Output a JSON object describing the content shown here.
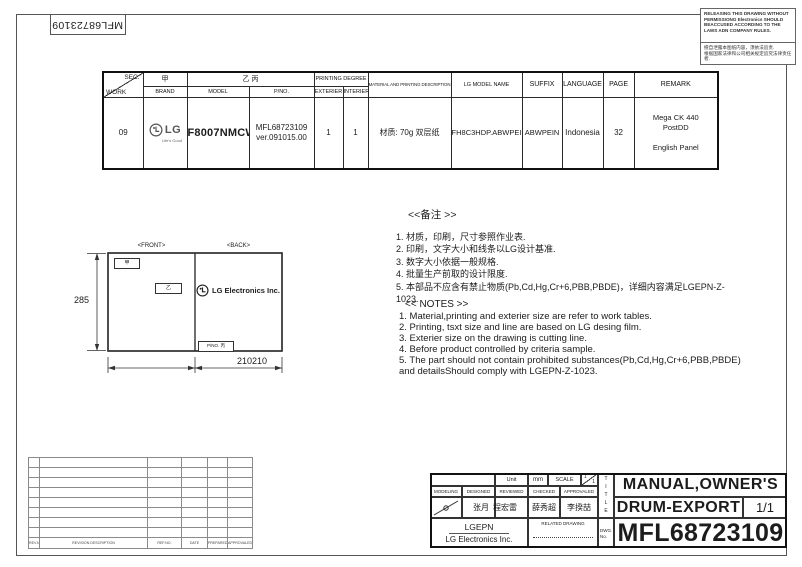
{
  "sheet": {
    "top_left_number": "MFL68723109",
    "disclaimer_en": "RELEASING THIS DRAWING WITHOUT PERMISSIONG Electronics SHOULD BEACCUSED ACCORDING TO THE LAWS ADN COMPANY RULES.",
    "disclaimer_cn_line1": "擅自泄露本图纸内容，须依法追责.",
    "disclaimer_cn_line2": "根据国家法律和公司相关规定追究法律责任者."
  },
  "spec_table": {
    "headers": {
      "sec": "SEC.",
      "work": "WORK",
      "jia": "甲",
      "brand": "BRAND",
      "yi_bing": "乙 丙",
      "model": "MODEL",
      "pno": "P/NO.",
      "printing_degree": "PRINTING DEGREE",
      "exterier": "EXTERIER",
      "interier": "INTERIER",
      "material": "MATERIAL AND PRINTING DESCRIPTION",
      "lg_model_name": "LG MODEL NAME",
      "suffix": "SUFFIX",
      "language": "LANGUAGE",
      "page": "PAGE",
      "remark": "REMARK"
    },
    "row": {
      "work_sec": "09",
      "brand_logo_text": "LG",
      "brand_tagline": "Life's Good",
      "model": "F8007NMCW",
      "pno_line1": "MFL68723109",
      "pno_line2": "ver.091015.00",
      "exterier": "1",
      "interier": "1",
      "material": "材质: 70g 双层纸",
      "lg_model_name": "FH8C3HDP.ABWPEIN",
      "suffix": "ABWPEIN",
      "language": "Indonesia",
      "page": "32",
      "remark": "Mega CK 440\nPostDD\n\nEnglish Panel"
    }
  },
  "drawing": {
    "front_label": "<FRONT>",
    "back_label": "<BACK>",
    "jia_box": "甲",
    "yi_box": "乙",
    "back_logo_text": "LG Electronics Inc.",
    "pno_box": "P/NO. 丙",
    "height_dim": "285",
    "width_dim": "210210"
  },
  "notes_cn": {
    "title": "<<备注 >>",
    "items": [
      "1.  材质，印刷，尺寸参照作业表.",
      "2.  印刷，文字大小和线条以LG设计基准.",
      "3.  数字大小依据一般规格.",
      "4.  批量生产前取的设计限度.",
      "5.  本部品不应含有禁止物质(Pb,Cd,Hg,Cr+6,PBB,PBDE)，详细内容满足LGEPN-Z-1023."
    ]
  },
  "notes_en": {
    "title": "<< NOTES >>",
    "items": [
      "1. Material,printing and exterier size are refer to work tables.",
      "2. Printing, tsxt  size and line are based on LG desing film.",
      "3. Exterier size on the drawing is cutting line.",
      "4. Before product controlled by criteria sample.",
      "5. The part should not contain prohibited substances(Pb,Cd,Hg,Cr+6,PBB,PBDE)\n    and detailsShould comply with LGEPN-Z-1023."
    ]
  },
  "revision_table": {
    "headers": [
      "REV.NO.",
      "REVISION DESCRIPTION",
      "REF.NO.",
      "DATE",
      "PREPARED",
      "APPROVALED"
    ]
  },
  "title_block": {
    "unit_label": "Unit",
    "unit_value": "mm",
    "scale_label": "SCALE",
    "scale_num": "1",
    "scale_den": "1",
    "modeling": "MODELING",
    "designed": "DESIGNED",
    "reviewed": "REVIEWED",
    "checked": "CHECKED",
    "approvaled": "APPROVALED",
    "sign_designed": "张月",
    "sign_reviewed": "程宏雷",
    "sign_checked": "薛秀超",
    "sign_approvaled": "李揆喆",
    "company_short": "LGEPN",
    "company_full": "LG Electronics Inc.",
    "related_drawing": "RELATED DRAWING",
    "dwg_label_1": "DWG.",
    "dwg_label_2": "No.",
    "title_vertical": "TITLE",
    "title_line1": "MANUAL,OWNER'S",
    "title_line2": "DRUM-EXPORT",
    "sheet_count": "1/1",
    "drawing_number": "MFL68723109"
  },
  "colors": {
    "line": "#2b2b2b",
    "logo_grey": "#555555"
  }
}
